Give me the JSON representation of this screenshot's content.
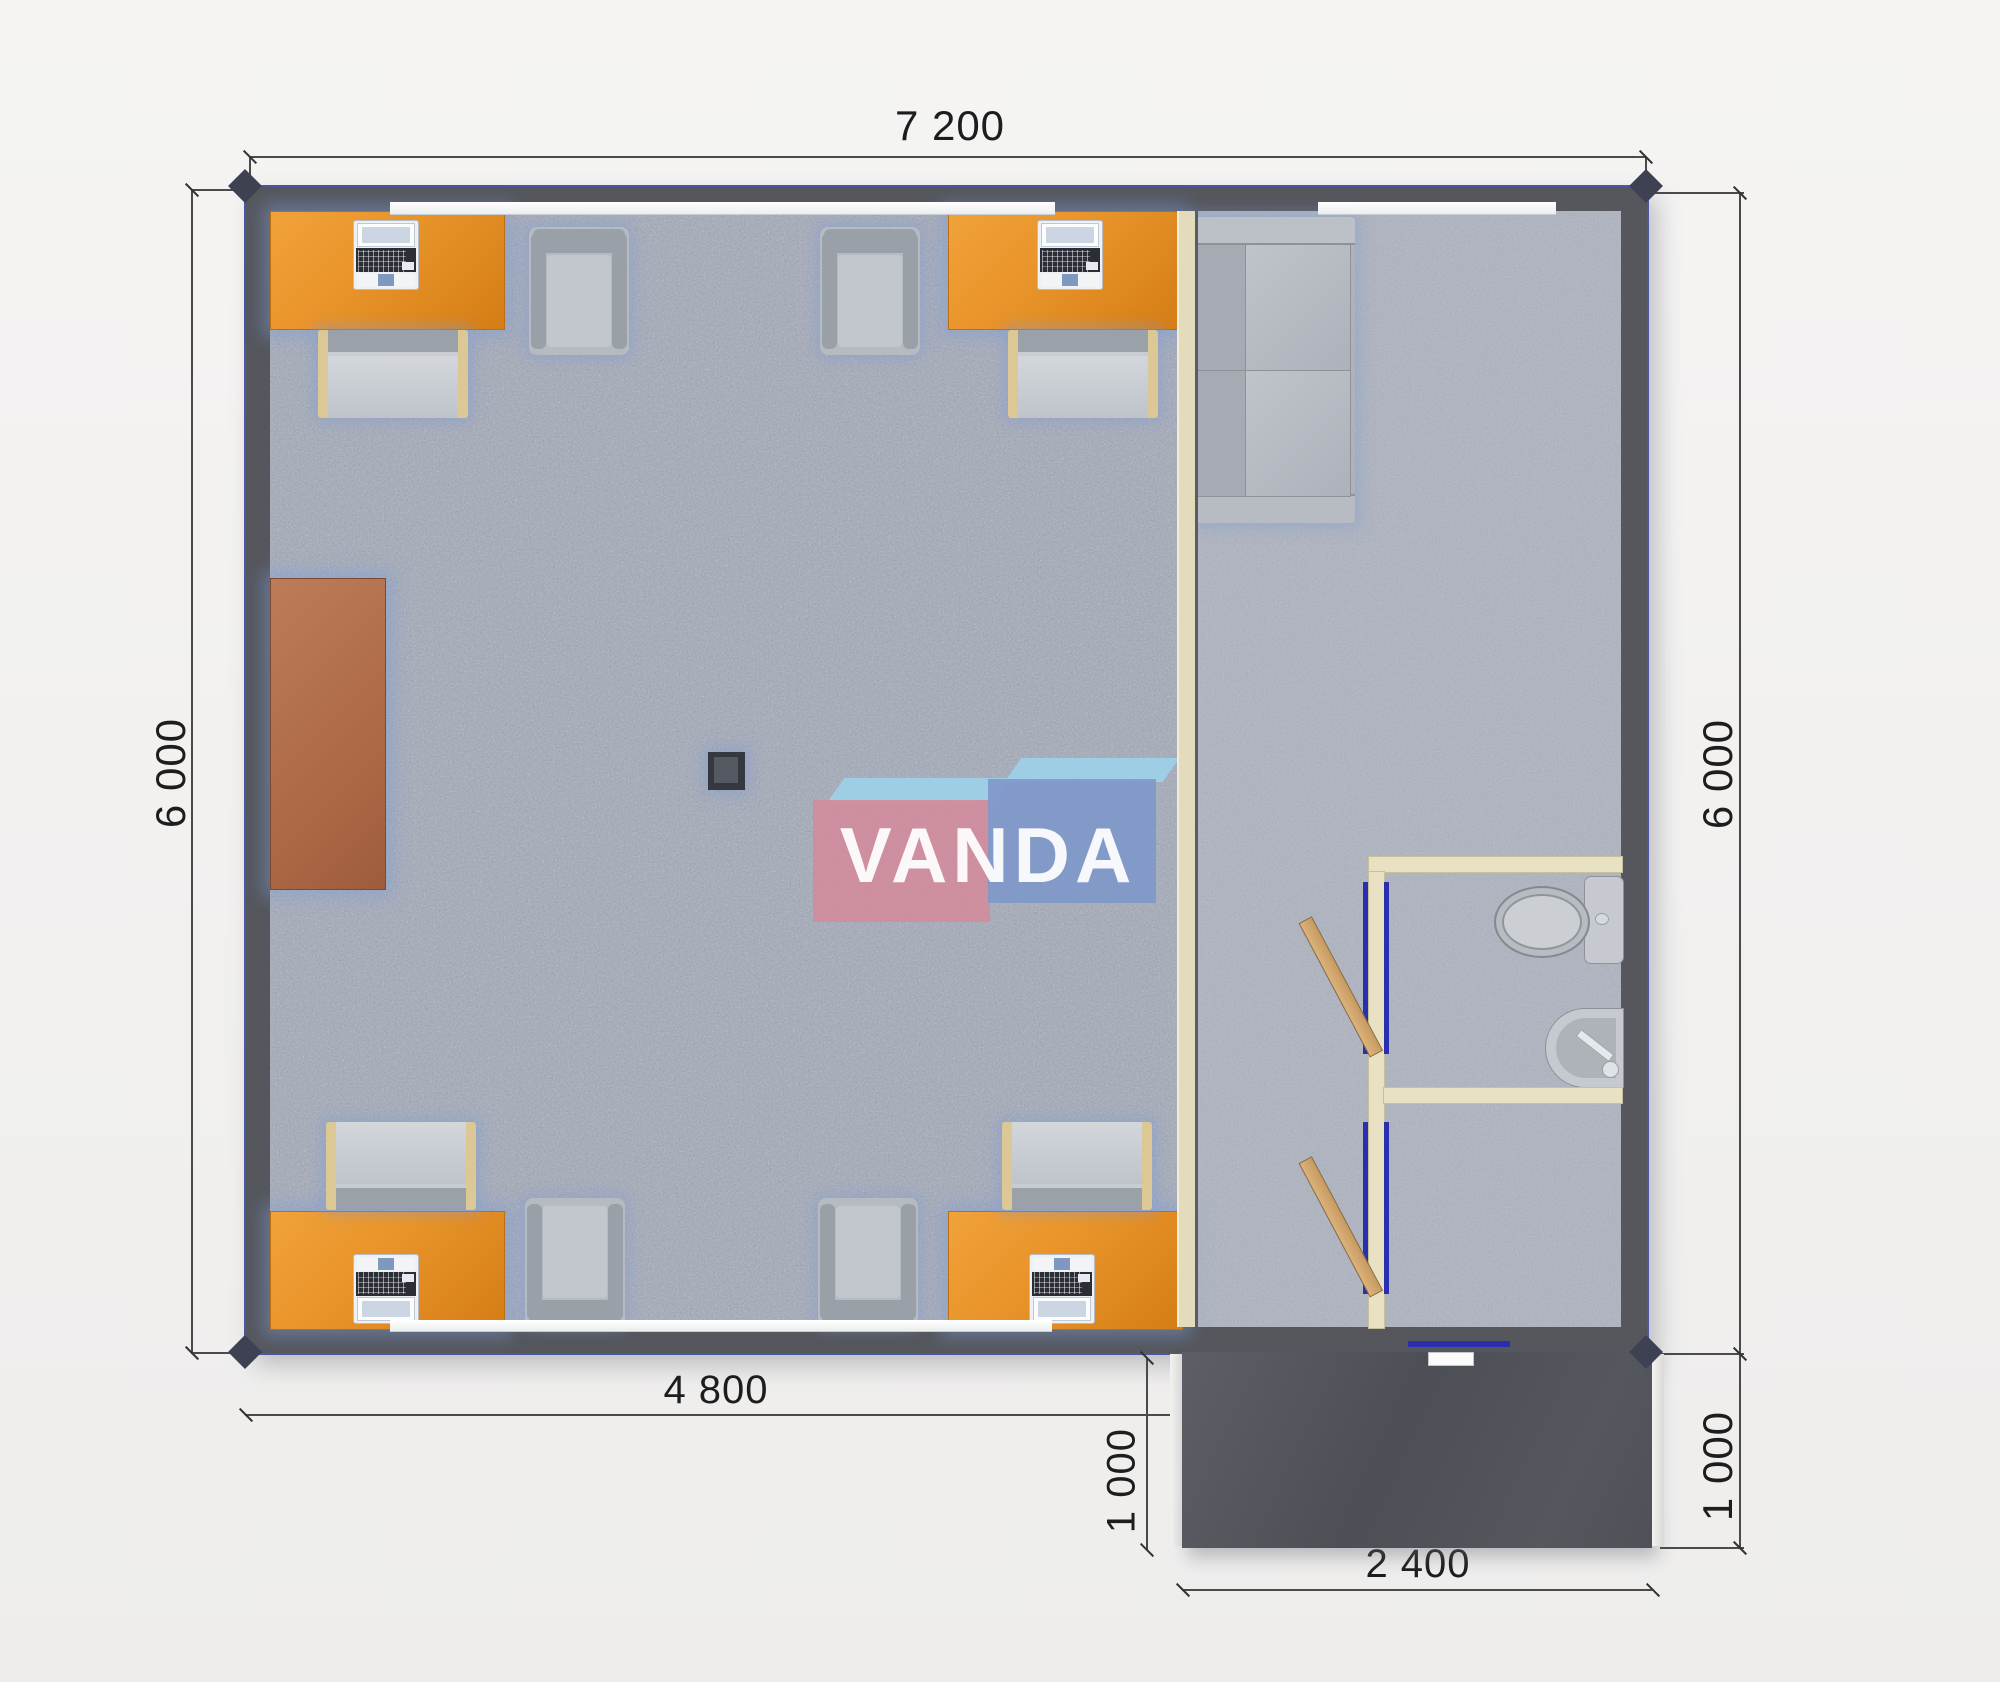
{
  "page": {
    "type": "floor-plan-render"
  },
  "brand": {
    "watermark": "VANDA"
  },
  "dimensions": {
    "top_width": "7 200",
    "left_height": "6 000",
    "right_height": "6 000",
    "room_width": "4 800",
    "porch_depth_left": "1 000",
    "porch_depth_right": "1 000",
    "porch_width": "2 400"
  },
  "colors": {
    "background": "#f3f2f1",
    "exterior_wall": "#55575d",
    "wall_accent_blue": "#4b57a0",
    "floor_speckle": "#bcc0cb",
    "desk_orange": "#e8932a",
    "cabinet_brown": "#b0714f",
    "seating_gray": "#aeb3bb",
    "chair_frame_beige": "#dcc894",
    "bathroom_wall_cream": "#e9e1c3",
    "door_frame_blue": "#2a2fae",
    "door_wood": "#cfa670",
    "porch_dark": "#54575d",
    "logo_pink": "#d28c9c",
    "logo_blue": "#7e98ca",
    "logo_light_blue": "#9cd3ea",
    "dimension_text": "#1d1d1d"
  },
  "furniture": {
    "main_room": [
      "desk-top-left",
      "desk-top-right",
      "desk-bottom-left",
      "desk-bottom-right",
      "laptop x4",
      "desk-chair x4",
      "armchair x4",
      "storage-cabinet",
      "stove-column"
    ],
    "lounge": [
      "sofa"
    ],
    "bathroom": [
      "toilet",
      "corner-sink",
      "wood-door x2"
    ],
    "outside": [
      "entry-porch",
      "entry-door"
    ]
  }
}
